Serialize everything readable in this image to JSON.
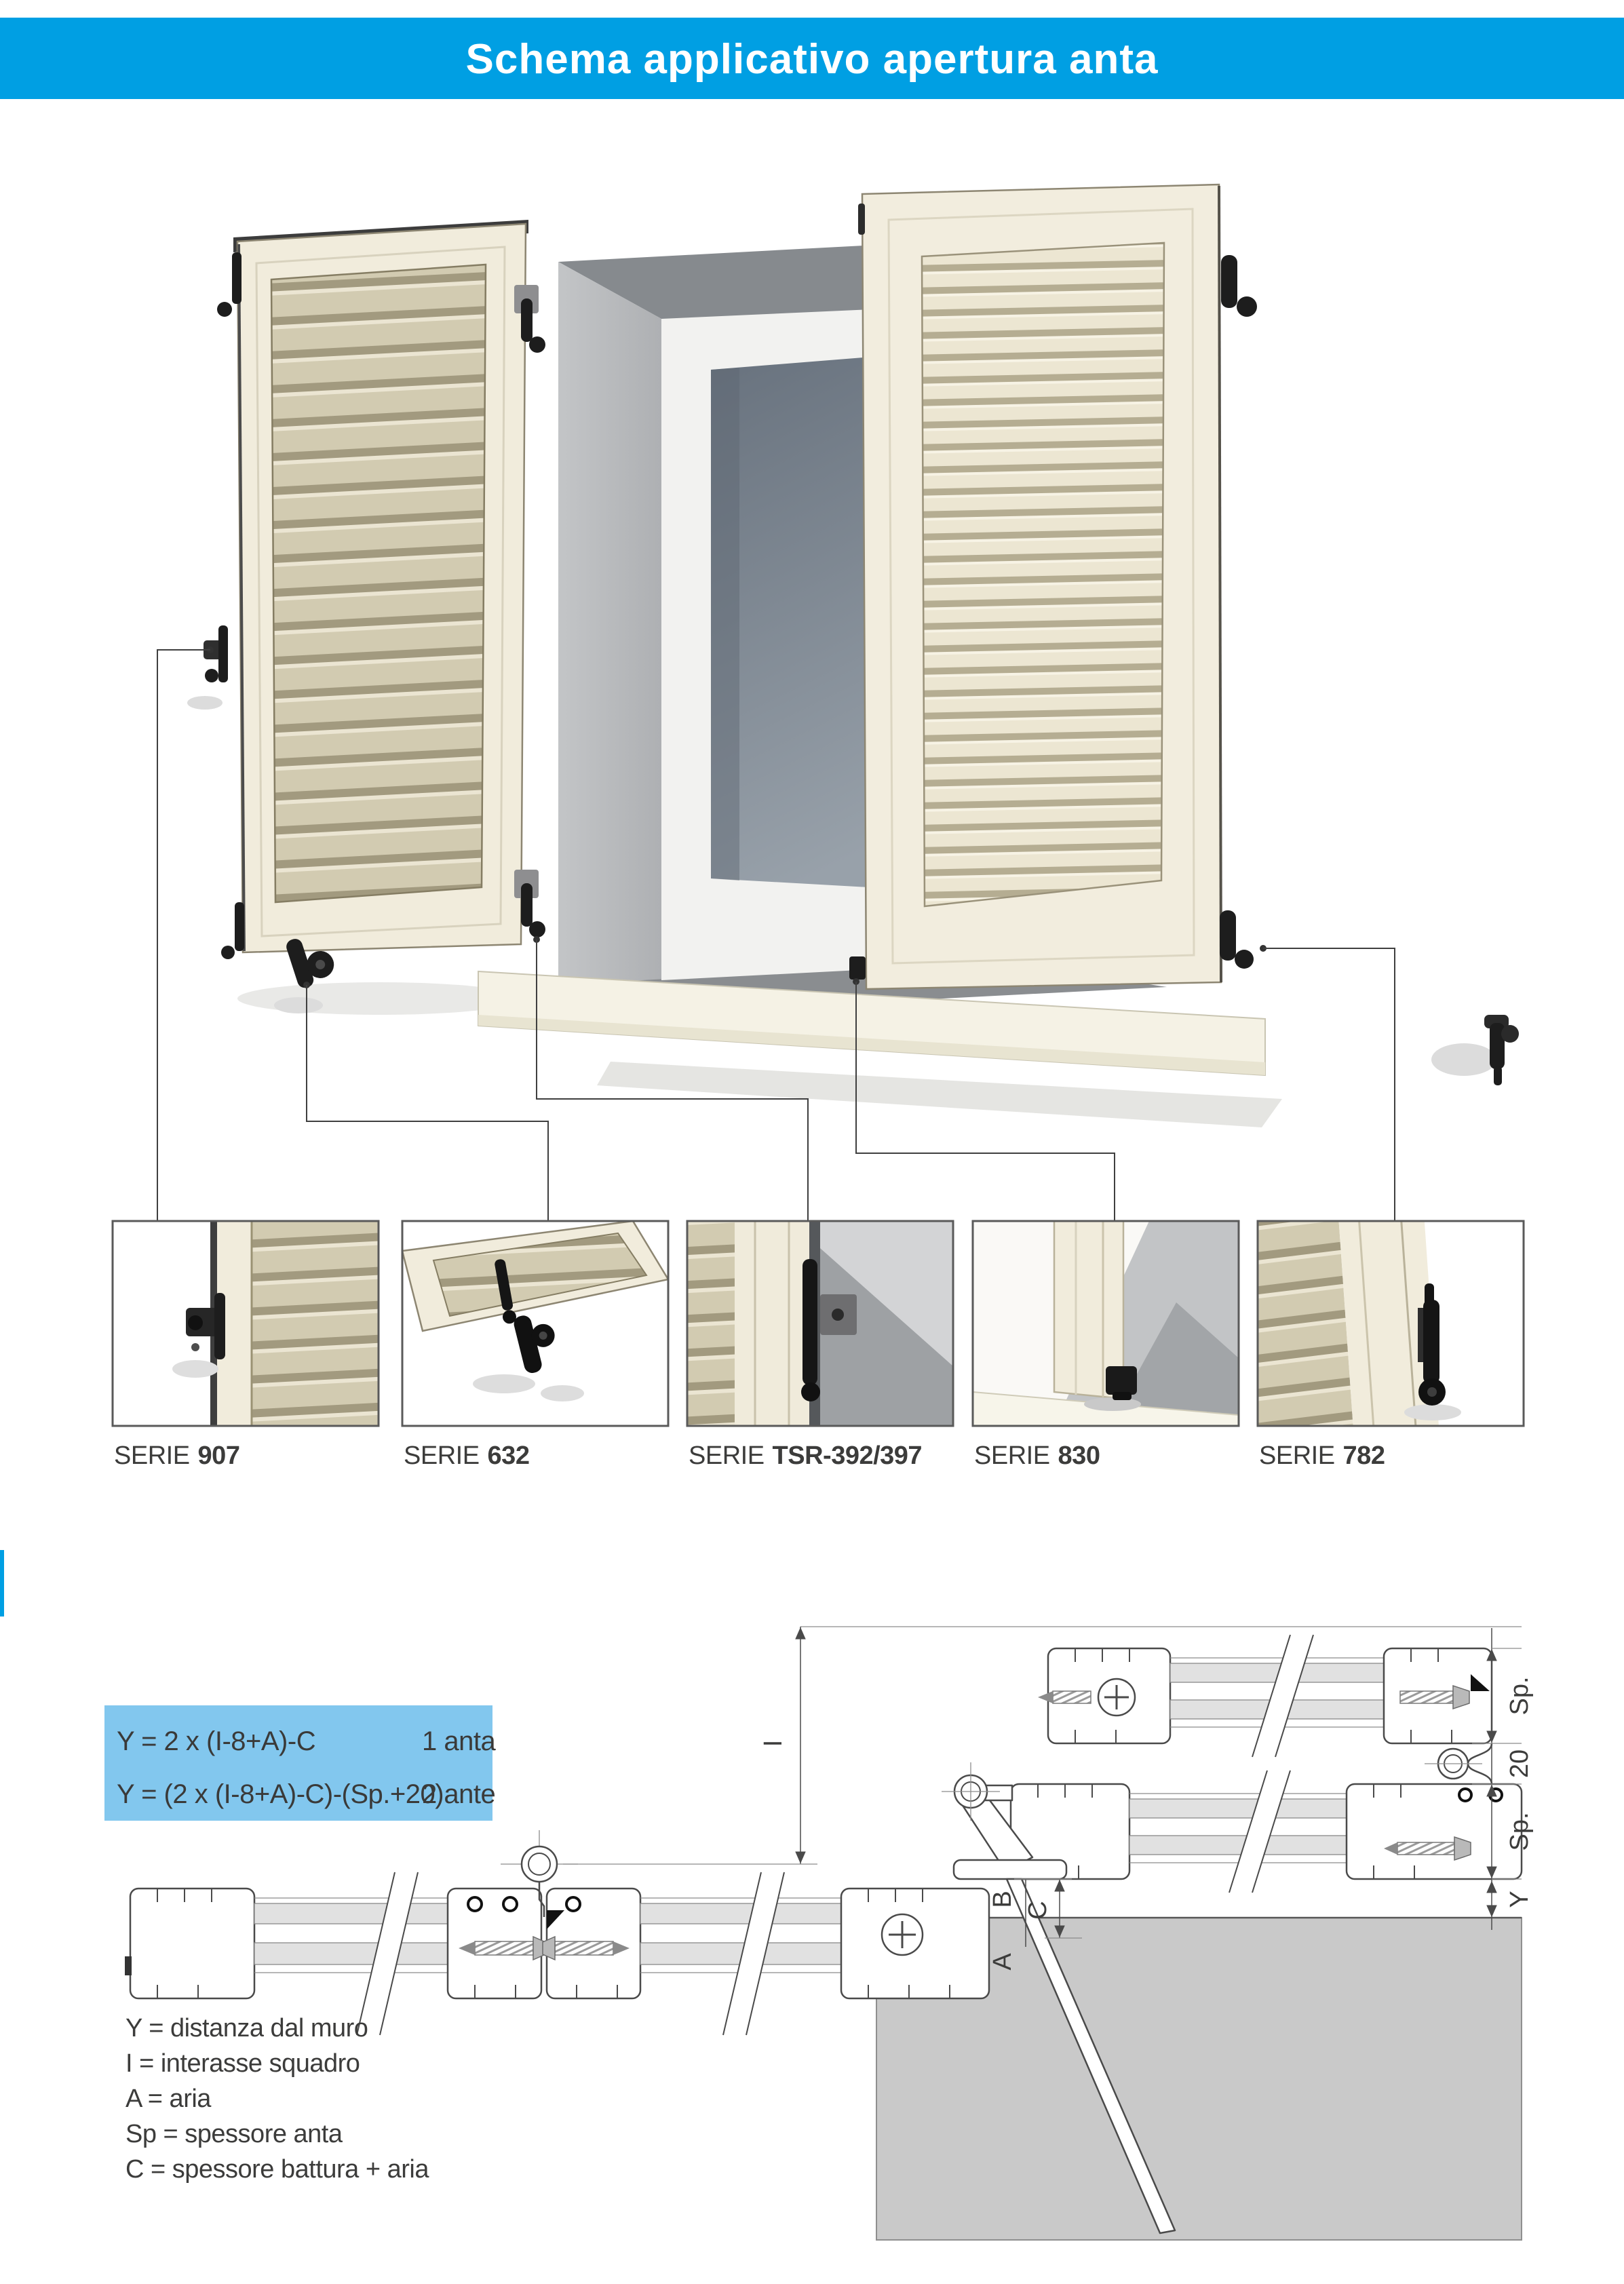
{
  "header": {
    "title": "Schema applicativo apertura anta"
  },
  "series": [
    {
      "prefix": "SERIE",
      "code": "907"
    },
    {
      "prefix": "SERIE",
      "code": "632"
    },
    {
      "prefix": "SERIE",
      "code": "TSR-392/397"
    },
    {
      "prefix": "SERIE",
      "code": "830"
    },
    {
      "prefix": "SERIE",
      "code": "782"
    }
  ],
  "formulas": {
    "rows": [
      {
        "formula": "Y = 2 x (I-8+A)-C",
        "applies_to": "1 anta"
      },
      {
        "formula": "Y = (2 x (I-8+A)-C)-(Sp.+20)",
        "applies_to": "2 ante"
      }
    ]
  },
  "legend": {
    "items": [
      "Y = distanza dal muro",
      "I = interasse squadro",
      "A = aria",
      "Sp = spessore anta",
      "C = spessore battura + aria"
    ]
  },
  "dimensions": {
    "sp_top": "Sp.",
    "gap_20": "20",
    "sp_bottom": "Sp.",
    "y": "Y",
    "i": "I",
    "b": "B",
    "c": "C",
    "a": "A"
  },
  "colors": {
    "accent_blue": "#009fe3",
    "formula_box_blue": "#82c7ee",
    "text_dark": "#3c3c3b",
    "wall_gray": "#c9c9c9",
    "shutter_cream": "#f1ecdc",
    "louver_tan": "#cfc8ae"
  }
}
